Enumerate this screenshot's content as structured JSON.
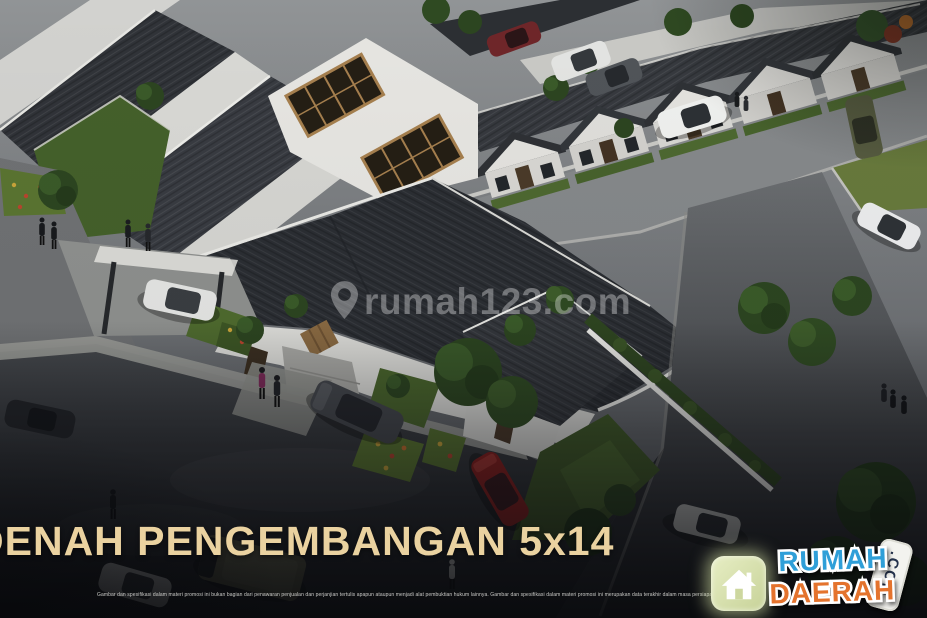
{
  "scene": {
    "description": "Aerial 3D render of a row-house residential estate: dark gable roofs, white walls, wood-framed clerestory windows, tree-lined streets, flower planters, parked cars and pedestrians at dusk"
  },
  "watermark": {
    "icon": "location-pin-icon",
    "text": "rumah123.com"
  },
  "title": {
    "text": "DENAH PENGEMBANGAN 5x14"
  },
  "logo": {
    "icon": "house-icon",
    "line1": "RUMAH",
    "line2": "DAERAH",
    "badge": ".COM"
  },
  "disclaimer": {
    "text": "Gambar dan spesifikasi dalam materi promosi ini bukan bagian dari penawaran penjualan dan perjanjian tertulis apapun ataupun menjadi alat pembuktian hukum lainnya.   Gambar dan spesifikasi dalam materi promosi ini merupakan data terakhir dalam masa persiapan"
  },
  "colors": {
    "title_text": "#EAD2A0",
    "logo_blue": "#2F9FD8",
    "logo_orange": "#E4732D",
    "badge_bg": "#F3F3EF",
    "badge_text": "#24324C",
    "watermark_white": "#FFFFFF",
    "roof_dark": "#2B2E33",
    "wall_white": "#D9D9D5",
    "grass_green": "#4E6A2E",
    "asphalt_dark": "#26282C"
  }
}
